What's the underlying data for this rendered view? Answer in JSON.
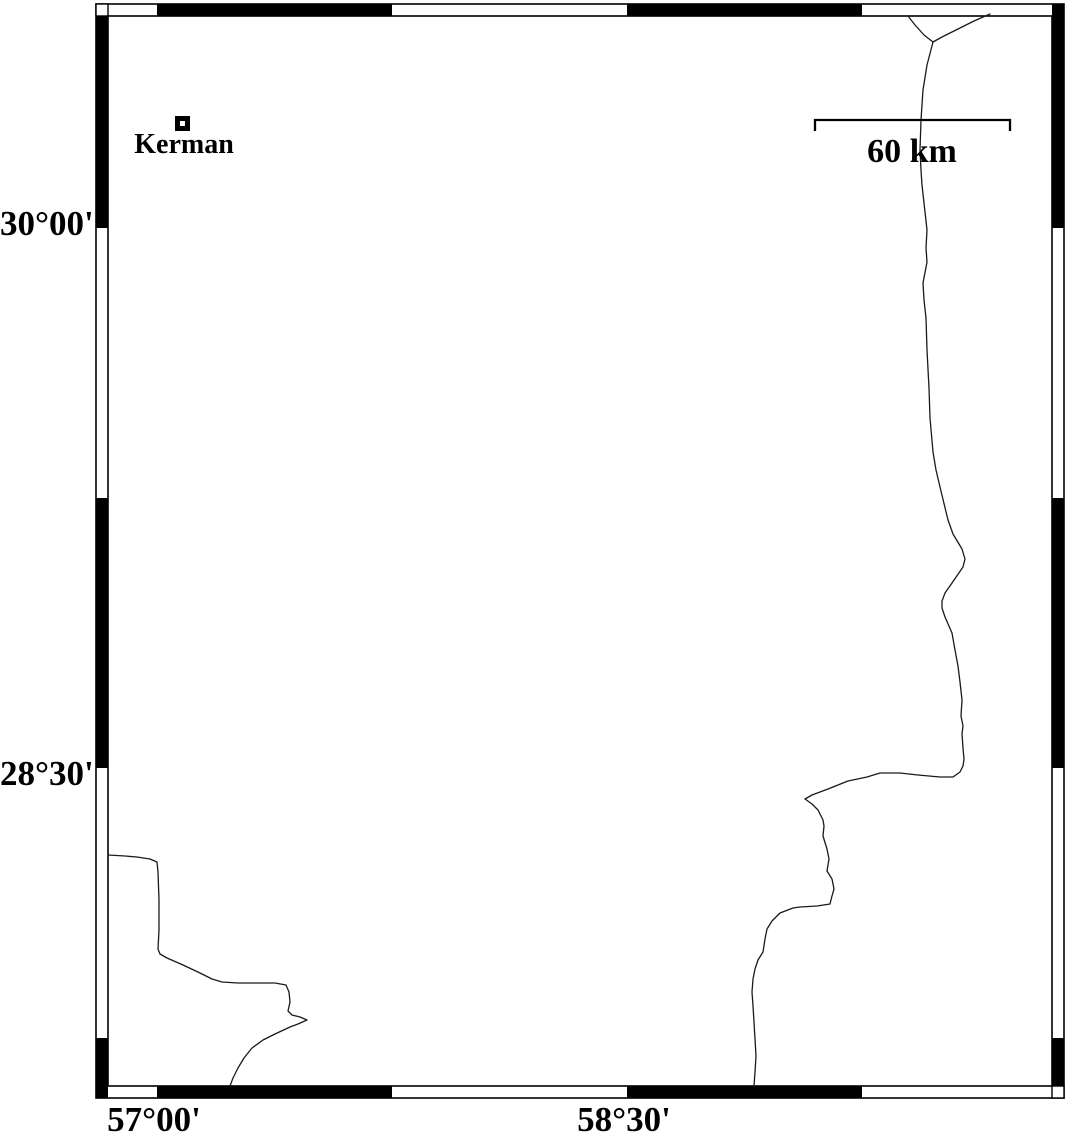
{
  "map": {
    "colors": {
      "background": "#ffffff",
      "frame_ink": "#000000",
      "line": "#1a1a1a"
    },
    "place": {
      "label": "Kerman",
      "marker": "hollow-square",
      "x": 182,
      "y": 123
    },
    "scale_bar": {
      "label": "60 km",
      "x1": 815,
      "x2": 1010,
      "y": 120,
      "tick_drop": 11
    },
    "axes": {
      "left_ticks": [
        {
          "label": "30°00'",
          "y": 228
        },
        {
          "label": "28°30'",
          "y": 768
        }
      ],
      "bottom_ticks": [
        {
          "label": "57°00'",
          "x": 157
        },
        {
          "label": "58°30'",
          "x": 627
        }
      ]
    },
    "map_lines": [
      {
        "name": "road-branch-west",
        "points": [
          [
            908,
            16
          ],
          [
            915,
            25
          ],
          [
            924,
            35
          ],
          [
            933,
            42
          ]
        ]
      },
      {
        "name": "road-branch-east",
        "points": [
          [
            990,
            14
          ],
          [
            974,
            21
          ],
          [
            956,
            30
          ],
          [
            942,
            37
          ],
          [
            933,
            42
          ]
        ]
      },
      {
        "name": "road-main",
        "points": [
          [
            933,
            42
          ],
          [
            927,
            65
          ],
          [
            923,
            90
          ],
          [
            921,
            120
          ],
          [
            920,
            150
          ],
          [
            921,
            170
          ],
          [
            922,
            185
          ],
          [
            925,
            212
          ],
          [
            927,
            230
          ],
          [
            926,
            248
          ],
          [
            927,
            262
          ],
          [
            923,
            283
          ],
          [
            924,
            300
          ],
          [
            926,
            318
          ],
          [
            927,
            350
          ],
          [
            929,
            388
          ],
          [
            930,
            418
          ],
          [
            933,
            452
          ],
          [
            936,
            470
          ],
          [
            940,
            487
          ],
          [
            948,
            520
          ],
          [
            953,
            534
          ],
          [
            962,
            549
          ],
          [
            965,
            559
          ],
          [
            963,
            567
          ],
          [
            952,
            583
          ],
          [
            945,
            593
          ],
          [
            942,
            601
          ],
          [
            942,
            608
          ],
          [
            945,
            617
          ],
          [
            952,
            633
          ],
          [
            955,
            650
          ],
          [
            958,
            666
          ],
          [
            960,
            682
          ],
          [
            962,
            700
          ],
          [
            961,
            716
          ],
          [
            963,
            726
          ],
          [
            962,
            734
          ],
          [
            963,
            748
          ],
          [
            964,
            759
          ],
          [
            963,
            766
          ],
          [
            960,
            772
          ],
          [
            953,
            777
          ],
          [
            940,
            777
          ],
          [
            918,
            775
          ],
          [
            900,
            773
          ],
          [
            880,
            773
          ],
          [
            867,
            777
          ],
          [
            848,
            781
          ],
          [
            828,
            789
          ],
          [
            812,
            795
          ],
          [
            805,
            799
          ],
          [
            812,
            804
          ],
          [
            818,
            810
          ],
          [
            823,
            820
          ],
          [
            824,
            826
          ],
          [
            823,
            836
          ],
          [
            827,
            849
          ],
          [
            829,
            859
          ],
          [
            827,
            871
          ],
          [
            832,
            879
          ],
          [
            834,
            889
          ],
          [
            832,
            896
          ],
          [
            830,
            904
          ],
          [
            817,
            906
          ],
          [
            800,
            907
          ],
          [
            793,
            908
          ],
          [
            780,
            913
          ],
          [
            772,
            921
          ],
          [
            767,
            929
          ],
          [
            765,
            939
          ],
          [
            763,
            952
          ],
          [
            758,
            960
          ],
          [
            755,
            969
          ],
          [
            753,
            979
          ],
          [
            752,
            992
          ],
          [
            753,
            1006
          ],
          [
            754,
            1022
          ],
          [
            755,
            1039
          ],
          [
            756,
            1056
          ],
          [
            755,
            1072
          ],
          [
            754,
            1086
          ]
        ]
      },
      {
        "name": "road-southwest",
        "points": [
          [
            108,
            855
          ],
          [
            125,
            856
          ],
          [
            137,
            857
          ],
          [
            150,
            859
          ],
          [
            157,
            862
          ],
          [
            158,
            872
          ],
          [
            159,
            900
          ],
          [
            159,
            930
          ],
          [
            158,
            949
          ],
          [
            160,
            954
          ],
          [
            167,
            958
          ],
          [
            183,
            965
          ],
          [
            200,
            973
          ],
          [
            212,
            979
          ],
          [
            222,
            982
          ],
          [
            238,
            983
          ],
          [
            258,
            983
          ],
          [
            275,
            983
          ],
          [
            286,
            985
          ],
          [
            289,
            992
          ],
          [
            290,
            1002
          ],
          [
            288,
            1011
          ],
          [
            292,
            1015
          ],
          [
            300,
            1017
          ],
          [
            307,
            1020
          ],
          [
            298,
            1024
          ],
          [
            290,
            1027
          ],
          [
            275,
            1034
          ],
          [
            263,
            1040
          ],
          [
            252,
            1048
          ],
          [
            244,
            1058
          ],
          [
            238,
            1068
          ],
          [
            233,
            1078
          ],
          [
            230,
            1086
          ]
        ]
      }
    ]
  }
}
